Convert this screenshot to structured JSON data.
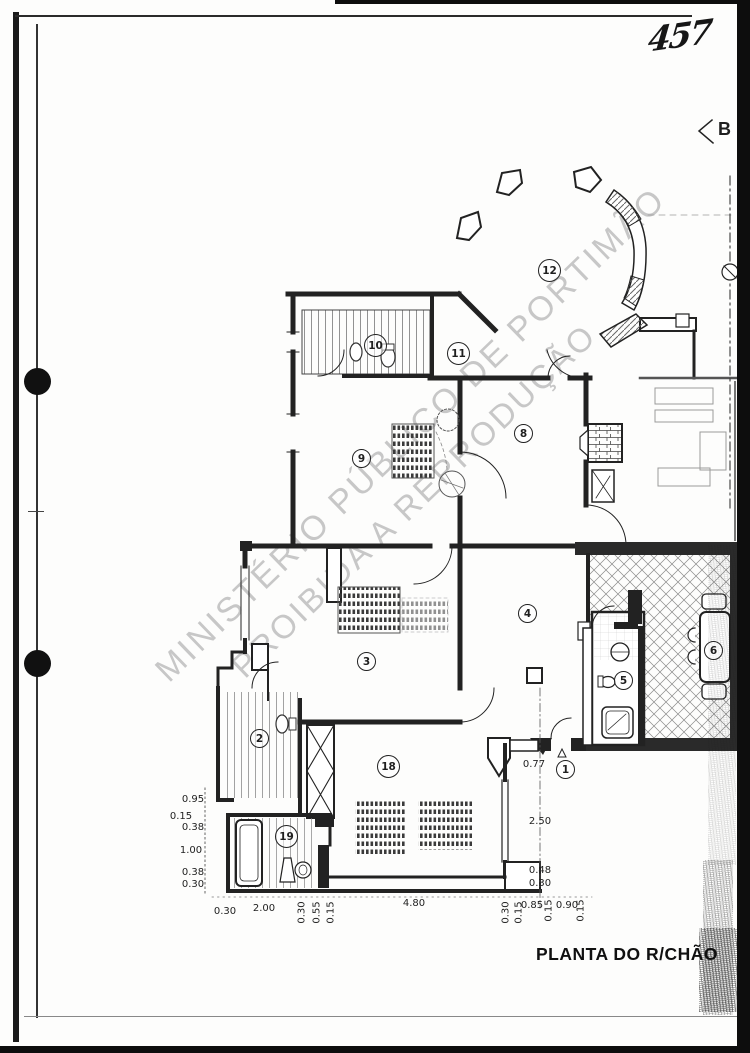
{
  "document": {
    "title": "PLANTA DO R/CHÃO",
    "handwritten_page_number": "457",
    "section_letter": "B"
  },
  "watermark": {
    "line1": "MINISTÉRIO PÚBLICO DE PORTIMÃO",
    "line2": "PROIBIDA A REPRODUÇÃO"
  },
  "room_labels": [
    "1",
    "2",
    "3",
    "4",
    "5",
    "6",
    "8",
    "9",
    "10",
    "11",
    "12",
    "18",
    "19"
  ],
  "dimensions": {
    "left": [
      "0.95",
      "0.15",
      "0.38",
      "1.00",
      "0.38",
      "0.30"
    ],
    "bottom": [
      "0.30",
      "2.00",
      "4.80",
      "0.85",
      "0.90"
    ],
    "bottom_rotated": [
      "0.30",
      "0.55",
      "0.15",
      "0.30",
      "0.15",
      "0.15",
      "0.15"
    ],
    "right": [
      "0.77",
      "2.50",
      "0.48",
      "0.30"
    ]
  },
  "colors": {
    "ink": "#1f1f1f",
    "watermark_gray": "#c7c7c7",
    "scan_border": "#0d0d0d"
  }
}
